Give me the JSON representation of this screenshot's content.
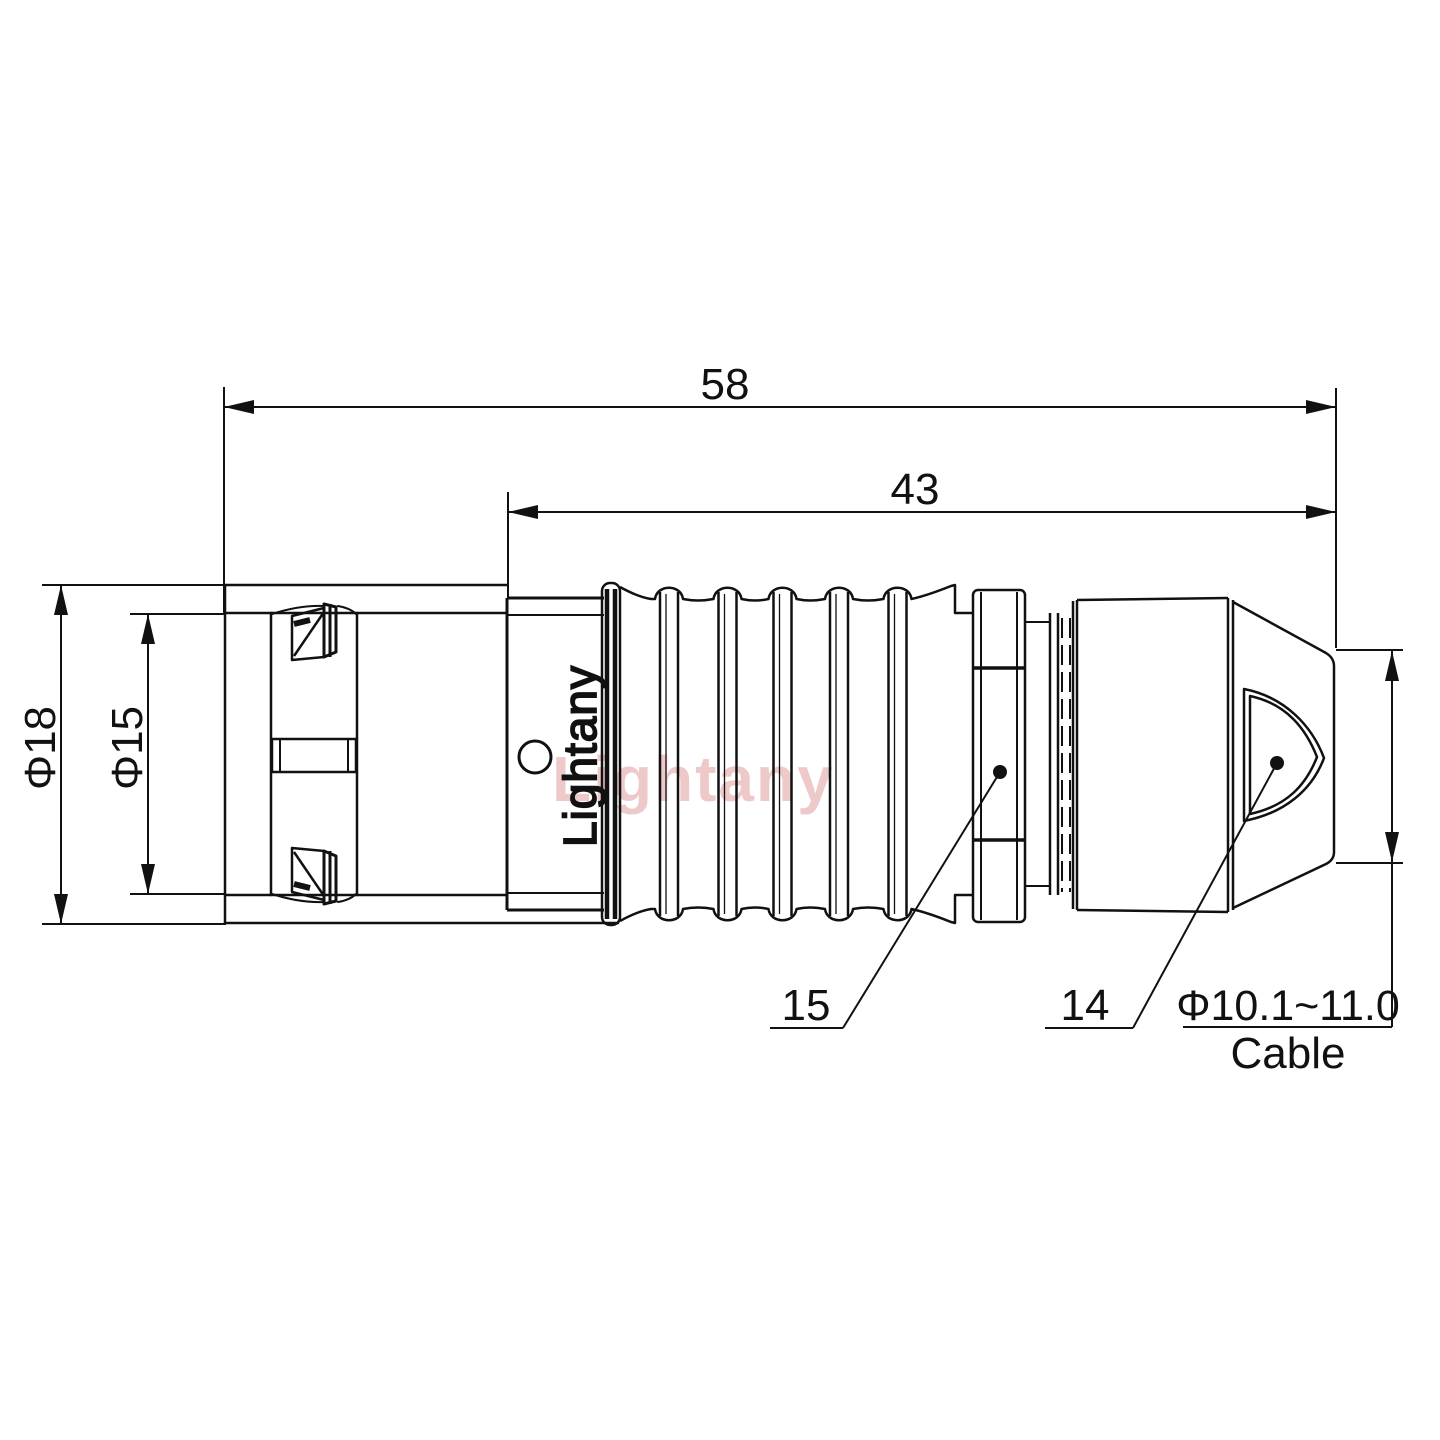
{
  "drawing": {
    "title_watermark": "Lightany",
    "brand_engraving": "Lightany",
    "dimensions": {
      "overall_length": "58",
      "front_length": "43",
      "outer_diameter": "Φ18",
      "inner_diameter": "Φ15",
      "cable_range": "Φ10.1~11.0",
      "cable_label": "Cable",
      "callout_strain_relief": "15",
      "callout_backnut": "14"
    },
    "colors": {
      "line": "#111111",
      "watermark": "#d98080",
      "background": "#ffffff"
    }
  }
}
